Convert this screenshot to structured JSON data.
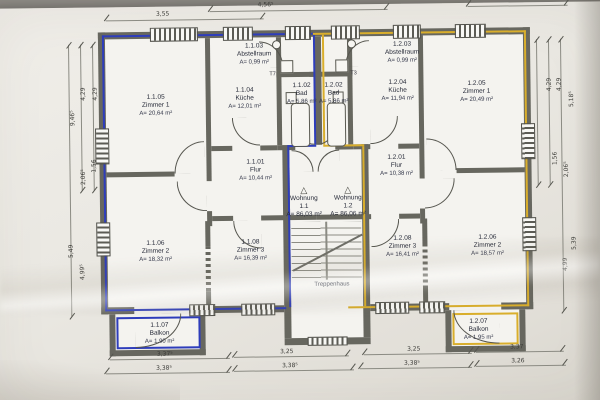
{
  "drawing": {
    "type": "floor-plan",
    "stairwell_label": "Treppenhaus"
  },
  "apartments": [
    {
      "label": "Wohnung",
      "no": "1.1",
      "area": "A= 86,03 m²",
      "x": 304,
      "y": 186
    },
    {
      "label": "Wohnung",
      "no": "1.2",
      "area": "A= 86,06 m²",
      "x": 348,
      "y": 186
    }
  ],
  "rooms": [
    {
      "no": "1.1.05",
      "name": "Zimmer 1",
      "area": "A= 20,64 m²",
      "x": 157,
      "y": 92
    },
    {
      "no": "1.1.04",
      "name": "Küche",
      "area": "A= 12,01 m²",
      "x": 246,
      "y": 86
    },
    {
      "no": "1.1.03",
      "name": "Abstellraum",
      "area": "A= 0,99 m²",
      "x": 256,
      "y": 42
    },
    {
      "no": "1.1.02",
      "name": "Bad",
      "area": "A= 5,86 m²",
      "x": 303,
      "y": 82
    },
    {
      "no": "1.1.01",
      "name": "Flur",
      "area": "A= 10,44 m²",
      "x": 256,
      "y": 158
    },
    {
      "no": "1.1.06",
      "name": "Zimmer 2",
      "area": "A= 18,32 m²",
      "x": 155,
      "y": 238
    },
    {
      "no": "1.1.08",
      "name": "Zimmer 3",
      "area": "A= 16,39 m²",
      "x": 250,
      "y": 238
    },
    {
      "no": "1.1.07",
      "name": "Balkon",
      "area": "A= 1,90 m²",
      "x": 158,
      "y": 320
    },
    {
      "no": "1.2.02",
      "name": "Bad",
      "area": "A= 5,86 m²",
      "x": 335,
      "y": 82
    },
    {
      "no": "1.2.03",
      "name": "Abstellraum",
      "area": "A= 0,99 m²",
      "x": 404,
      "y": 42
    },
    {
      "no": "1.2.04",
      "name": "Küche",
      "area": "A= 11,94 m²",
      "x": 399,
      "y": 80
    },
    {
      "no": "1.2.05",
      "name": "Zimmer 1",
      "area": "A= 20,49 m²",
      "x": 478,
      "y": 82
    },
    {
      "no": "1.2.01",
      "name": "Flur",
      "area": "A= 10,38 m²",
      "x": 397,
      "y": 155
    },
    {
      "no": "1.2.08",
      "name": "Zimmer 3",
      "area": "A= 16,41 m²",
      "x": 402,
      "y": 236
    },
    {
      "no": "1.2.06",
      "name": "Zimmer 2",
      "area": "A= 18,57 m²",
      "x": 487,
      "y": 236
    },
    {
      "no": "1.2.07",
      "name": "Balkon",
      "area": "A= 1,95 m²",
      "x": 477,
      "y": 320
    }
  ],
  "door_tags": [
    {
      "text": "T7",
      "x": 271,
      "y": 71
    },
    {
      "text": "T3",
      "x": 352,
      "y": 71
    }
  ],
  "dims": {
    "labels": [
      {
        "text": "3,55",
        "x": 165,
        "y": 9
      },
      {
        "text": "4,56⁵",
        "x": 268,
        "y": 1
      },
      {
        "text": "3,37⁵",
        "x": 163,
        "y": 349
      },
      {
        "text": "3,25",
        "x": 285,
        "y": 348
      },
      {
        "text": "3,25",
        "x": 412,
        "y": 347
      },
      {
        "text": "3,37",
        "x": 515,
        "y": 346
      },
      {
        "text": "3,38⁵",
        "x": 162,
        "y": 363
      },
      {
        "text": "3,38⁵",
        "x": 288,
        "y": 362
      },
      {
        "text": "3,38⁵",
        "x": 410,
        "y": 361
      },
      {
        "text": "3,26",
        "x": 516,
        "y": 360
      },
      {
        "text": "4,29",
        "x": 78,
        "y": 88,
        "rot": true
      },
      {
        "text": "4,29",
        "x": 90,
        "y": 88,
        "rot": true
      },
      {
        "text": "9,46⁵",
        "x": 66,
        "y": 112,
        "rot": true
      },
      {
        "text": "1,56",
        "x": 88,
        "y": 160,
        "rot": true
      },
      {
        "text": "2,06⁵",
        "x": 76,
        "y": 171,
        "rot": true
      },
      {
        "text": "5,49",
        "x": 64,
        "y": 245,
        "rot": true
      },
      {
        "text": "4,99⁵",
        "x": 74,
        "y": 266,
        "rot": true
      },
      {
        "text": "4,29",
        "x": 544,
        "y": 84,
        "rot": true
      },
      {
        "text": "4,29",
        "x": 554,
        "y": 84,
        "rot": true
      },
      {
        "text": "5,18⁵",
        "x": 565,
        "y": 99,
        "rot": true
      },
      {
        "text": "1,56",
        "x": 549,
        "y": 158,
        "rot": true
      },
      {
        "text": "2,06⁵",
        "x": 559,
        "y": 169,
        "rot": true
      },
      {
        "text": "5,39",
        "x": 567,
        "y": 243,
        "rot": true
      },
      {
        "text": "4,99",
        "x": 558,
        "y": 264,
        "rot": true
      }
    ]
  },
  "icons": {
    "entrance_marker": "△"
  },
  "colors": {
    "wall": "#67675f",
    "apartment1_accent": "#2e3dbb",
    "apartment2_accent": "#d9ae2c",
    "paper": "#eceae4"
  }
}
